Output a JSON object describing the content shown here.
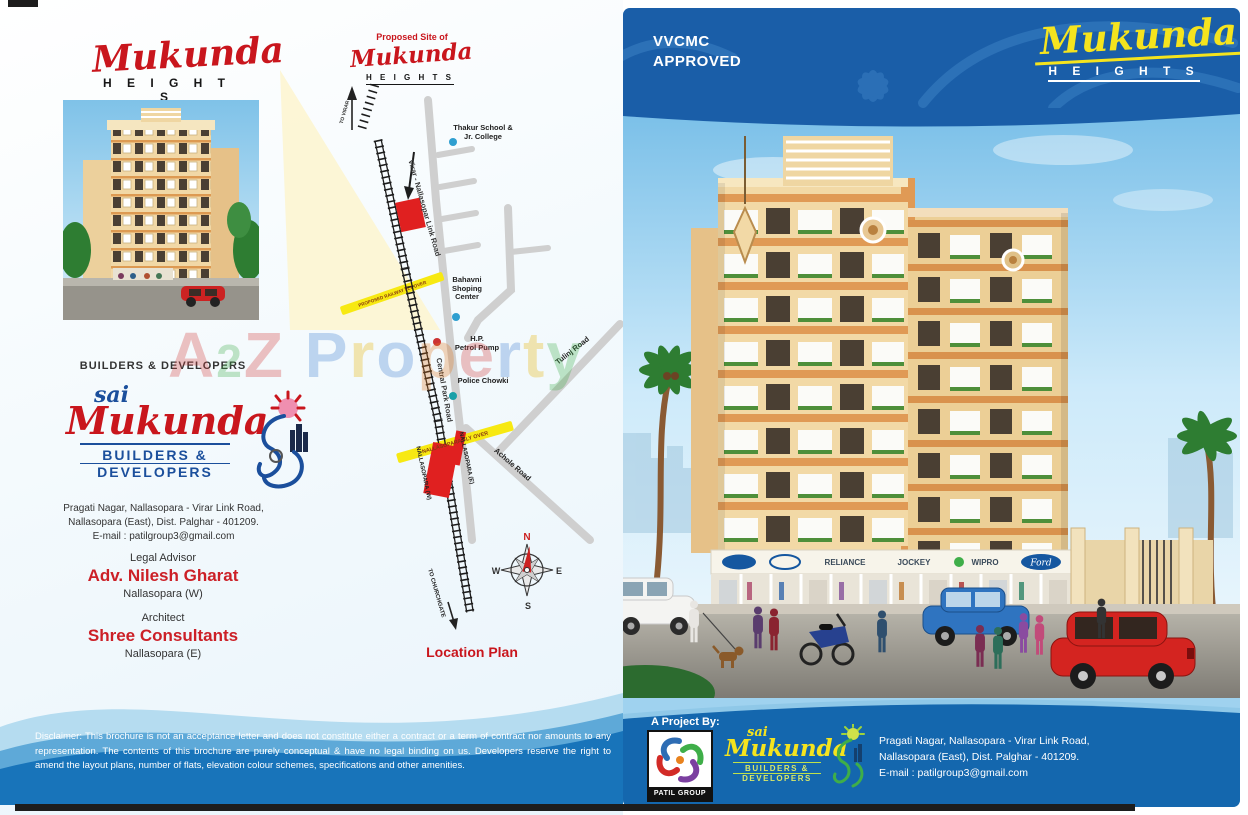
{
  "page": {
    "watermark": "A2Z Property"
  },
  "colors": {
    "brand_red": "#c9161d",
    "brand_blue": "#1b4f9c",
    "panel_blue": "#1a5ea8",
    "accent_yellow": "#f5e41e",
    "map_flyover_yellow": "#f7e912",
    "station_red": "#e02020"
  },
  "left": {
    "logo": {
      "script": "Mukunda",
      "block": "H E I G H T S"
    },
    "builders_heading": "BUILDERS  &  DEVELOPERS",
    "brand": {
      "pre": "sai",
      "script": "Mukunda",
      "sub1": "BUILDERS &",
      "sub2": "DEVELOPERS"
    },
    "address": [
      "Pragati Nagar, Nallasopara - Virar Link Road,",
      "Nallasopara (East), Dist. Palghar - 401209.",
      "E-mail : patilgroup3@gmail.com"
    ],
    "legal": {
      "title": "Legal Advisor",
      "name": "Adv. Nilesh Gharat",
      "loc": "Nallasopara (W)"
    },
    "architect": {
      "title": "Architect",
      "name": "Shree Consultants",
      "loc": "Nallasopara (E)"
    },
    "disclaimer": "Disclaimer: This brochure is not an acceptance letter and does not constitute either a contract or a term of contract nor amounts to any representation. The contents of this brochure are purely conceptual & have no legal binding on us. Developers reserve the right to amend the layout plans, number of flats, elevation colour schemes, specifications and other amenities."
  },
  "map": {
    "title": "Location Plan",
    "proposed_site": "Proposed  Site of",
    "site_logo_script": "Mukunda",
    "site_logo_block": "H E I G H T S",
    "link_road": "Virar - Nallasopar Link Road",
    "school": [
      "Thakur School &",
      "Jr. College"
    ],
    "shopping": [
      "Bahavni",
      "Shoping",
      "Center"
    ],
    "petrol": [
      "H.P.",
      "Petrol Pump"
    ],
    "police": "Police Chowki",
    "central_park": "Central Park Road",
    "achole": "Achole Road",
    "tulinj": "Tulinj Road",
    "flyover_proposed": "PROPOSED RAILWAY FLY OVER",
    "flyover_nallasopara": "NALLASOPARA FLY OVER",
    "station_e": "NALLASOPARA (E)",
    "station_w": "NALLASOPARA (W)",
    "to_churchgate": "TO CHURCHGATE",
    "to_virar": "TO VIRAR",
    "compass": {
      "n": "N",
      "e": "E",
      "s": "S",
      "w": "W"
    }
  },
  "right": {
    "approved": [
      "VVCMC",
      "APPROVED"
    ],
    "logo": {
      "script": "Mukunda",
      "block": "H E I G H T S"
    },
    "signs": [
      "RELIANCE",
      "JOCKEY",
      "WIPRO",
      "Ford"
    ],
    "footer": {
      "project_by": "A Project By:",
      "patil": "PATIL GROUP",
      "brand": {
        "pre": "sai",
        "script": "Mukunda",
        "sub1": "BUILDERS &",
        "sub2": "DEVELOPERS"
      },
      "address": [
        "Pragati Nagar, Nallasopara - Virar Link Road,",
        "Nallasopara (East), Dist. Palghar - 401209.",
        "E-mail : patilgroup3@gmail.com"
      ]
    }
  }
}
